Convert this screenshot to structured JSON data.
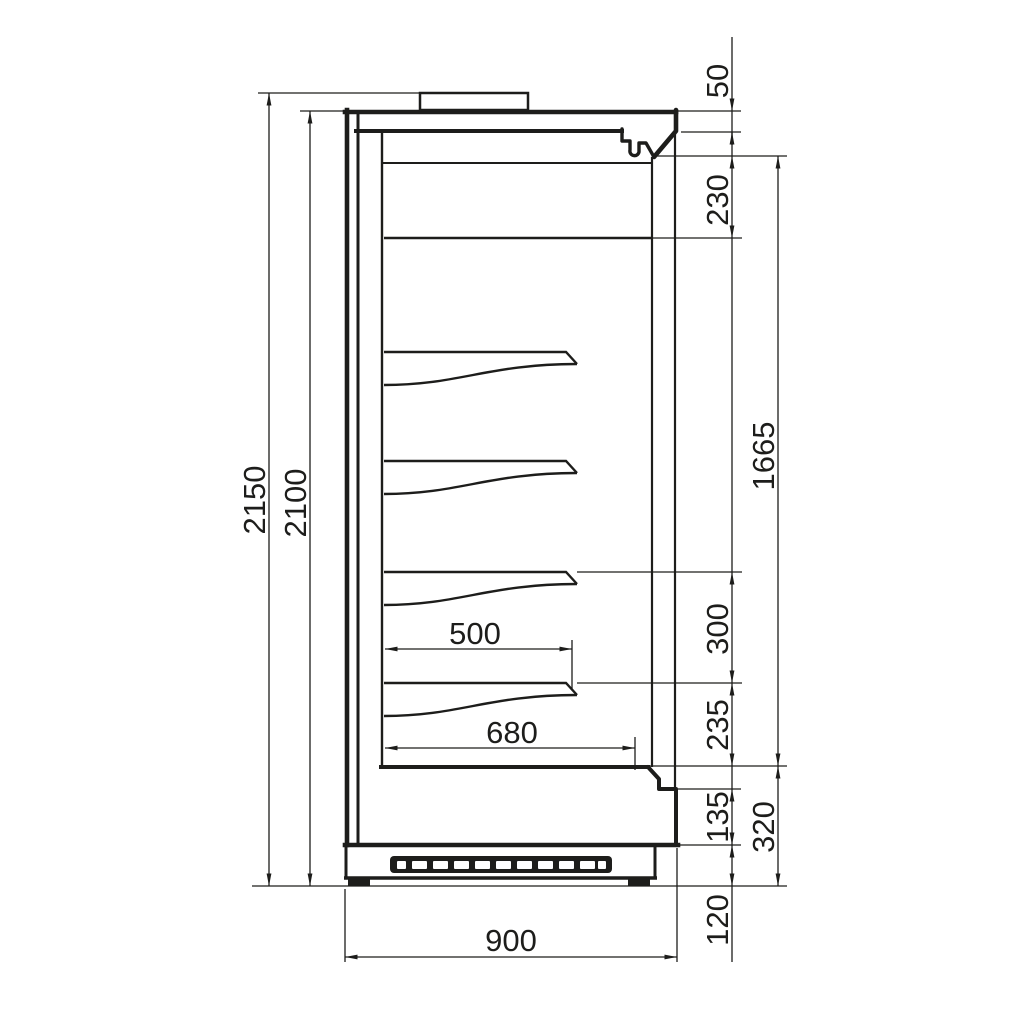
{
  "drawing": {
    "title": "Refrigerated multideck display cabinet — side cross-section with dimensions",
    "units": "mm",
    "ink_color": "#1d1d1b",
    "background_color": "#ffffff"
  },
  "dims": {
    "overall_height": "2150",
    "body_height": "2100",
    "canopy_front": "50",
    "top_clearance": "230",
    "display_opening": "1665",
    "shelf_spacing": "300",
    "bottom_clearance": "235",
    "front_panel": "135",
    "base_section": "320",
    "plinth_height": "120",
    "shelf_depth": "500",
    "deck_depth": "680",
    "overall_depth": "900"
  }
}
